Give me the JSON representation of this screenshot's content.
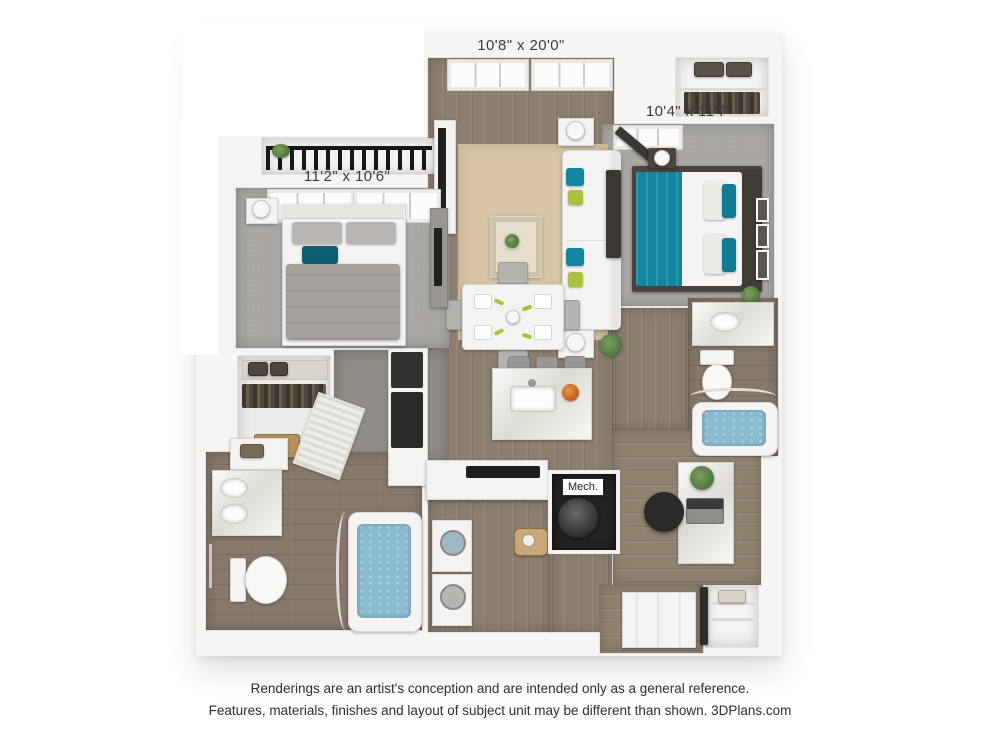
{
  "floorplan": {
    "labels": {
      "living_room": "10'8\" x 20'0\"",
      "bedroom_right": "10'4\" x 11'7\"",
      "bedroom_left": "11'2\" x 10'6\"",
      "mech": "Mech."
    },
    "colors": {
      "wood_floor": "#8d7e6f",
      "tile_floor": "#87786a",
      "carpet": "#a9a6a3",
      "area_rug": "#d8c6a6",
      "accent_teal": "#11869e",
      "accent_green": "#a8c23f",
      "tub_water": "#8abcd2",
      "wall": "#f6f5f3",
      "dark_furniture": "#3b3734",
      "marble": "#eae8e2"
    }
  },
  "footer": {
    "line1": "Renderings are an artist's conception and are intended only as a general reference.",
    "line2": "Features, materials, finishes and layout of subject unit may be different than shown. 3DPlans.com"
  }
}
